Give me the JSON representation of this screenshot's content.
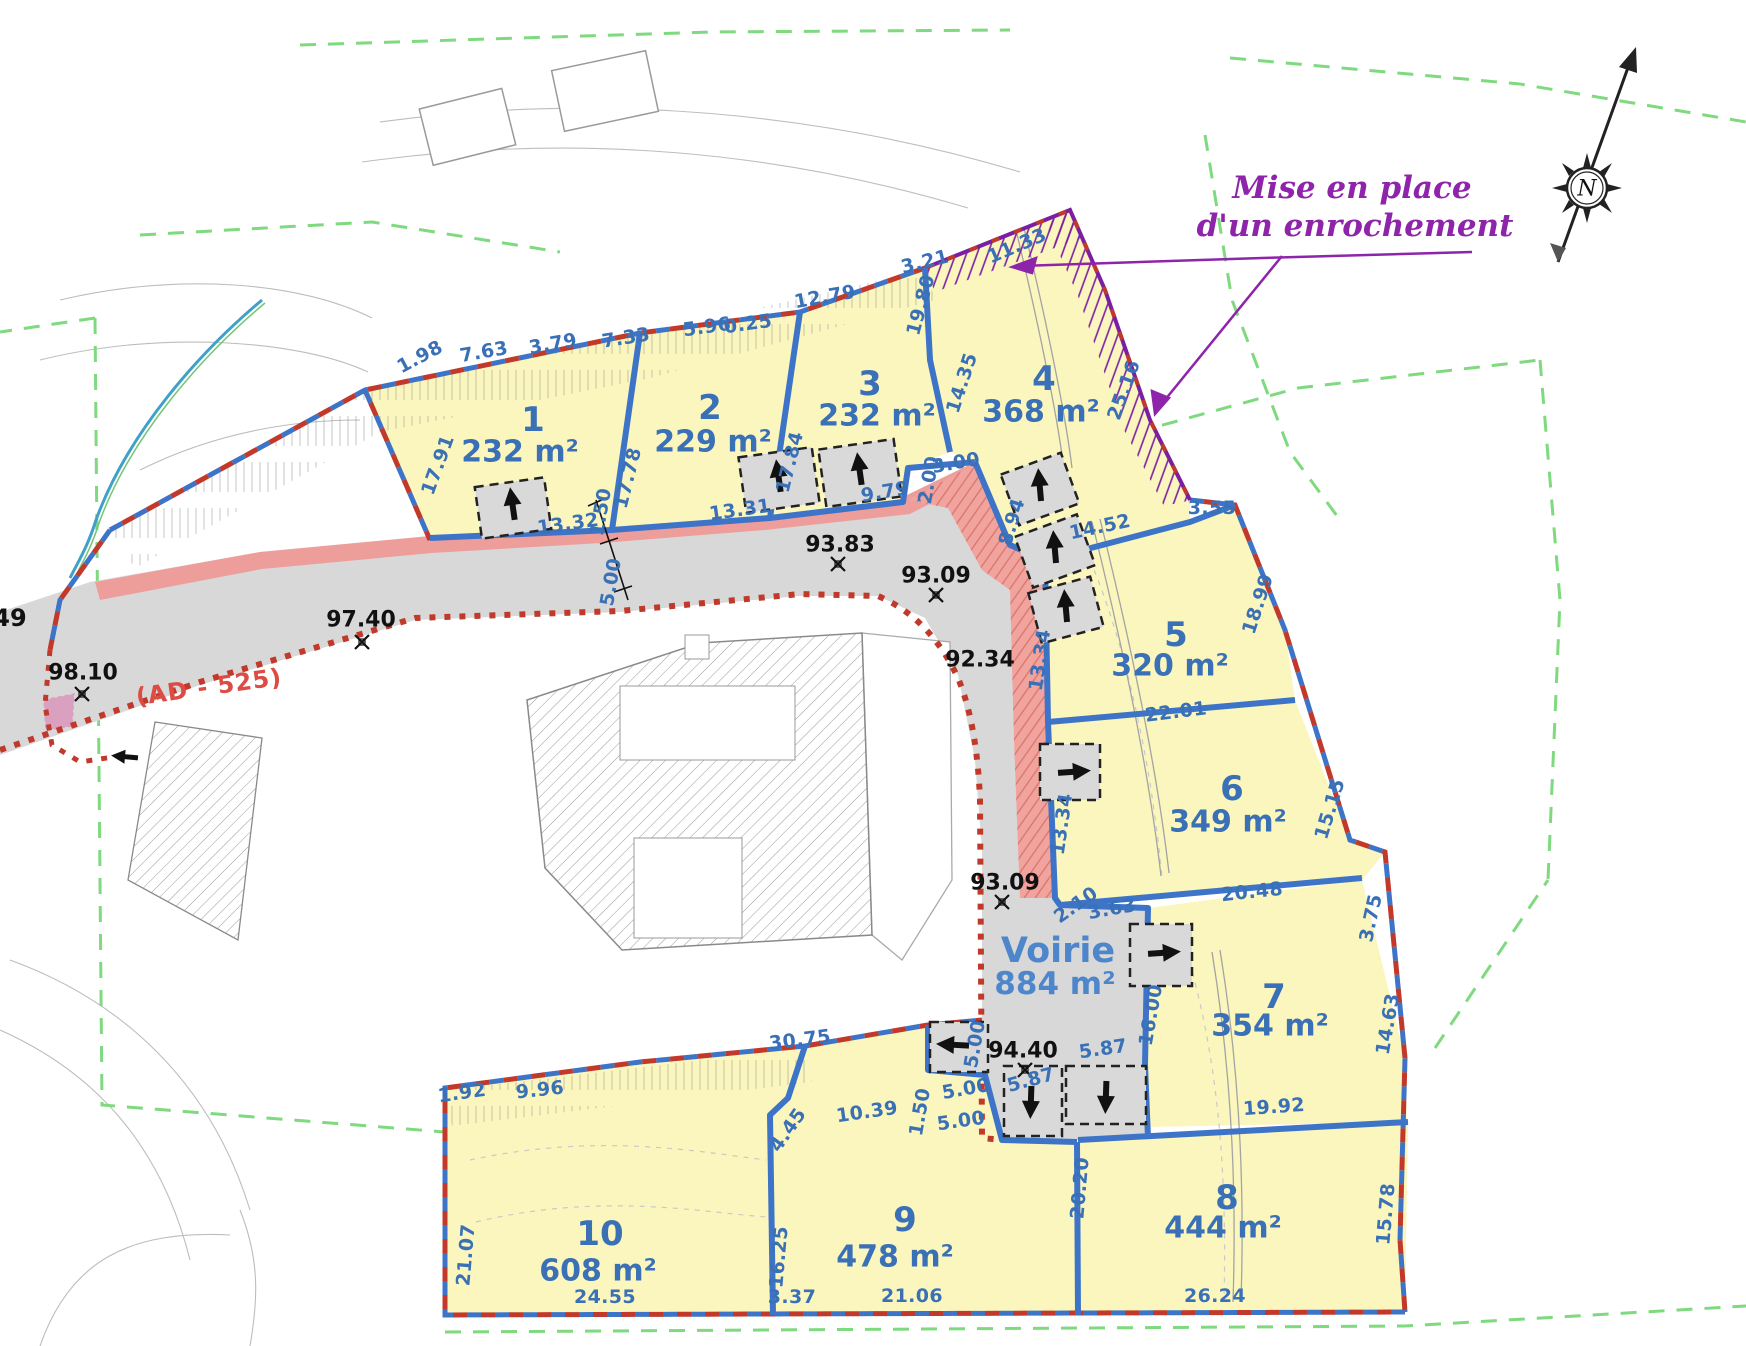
{
  "plan": {
    "annotation": {
      "line1": "Mise en place",
      "line2": "d'un enrochement"
    },
    "compass_label": "N",
    "road_label": "(AD - 525)",
    "edge_label": "49",
    "voirie": {
      "name": "Voirie",
      "area": "884 m²"
    },
    "lots": [
      {
        "num": "1",
        "area": "232 m²"
      },
      {
        "num": "2",
        "area": "229 m²"
      },
      {
        "num": "3",
        "area": "232 m²"
      },
      {
        "num": "4",
        "area": "368 m²"
      },
      {
        "num": "5",
        "area": "320 m²"
      },
      {
        "num": "6",
        "area": "349 m²"
      },
      {
        "num": "7",
        "area": "354 m²"
      },
      {
        "num": "8",
        "area": "444 m²"
      },
      {
        "num": "9",
        "area": "478 m²"
      },
      {
        "num": "10",
        "area": "608 m²"
      }
    ],
    "elevations": [
      {
        "v": "98.10"
      },
      {
        "v": "97.40"
      },
      {
        "v": "93.83"
      },
      {
        "v": "93.09"
      },
      {
        "v": "92.34"
      },
      {
        "v": "93.09"
      },
      {
        "v": "94.40"
      }
    ],
    "dims": [
      {
        "v": "1.98"
      },
      {
        "v": "7.63"
      },
      {
        "v": "3.79"
      },
      {
        "v": "7.33"
      },
      {
        "v": "5.96"
      },
      {
        "v": "0.25"
      },
      {
        "v": "12.79"
      },
      {
        "v": "3.21"
      },
      {
        "v": "11.33"
      },
      {
        "v": "17.91"
      },
      {
        "v": "17.78"
      },
      {
        "v": "17.84"
      },
      {
        "v": "19.80"
      },
      {
        "v": "14.35"
      },
      {
        "v": "25.16"
      },
      {
        "v": "13.32"
      },
      {
        "v": "13.31"
      },
      {
        "v": "9.79"
      },
      {
        "v": "2.00"
      },
      {
        "v": "3.00"
      },
      {
        "v": "8.94"
      },
      {
        "v": "14.52"
      },
      {
        "v": "3.55"
      },
      {
        "v": "1.50"
      },
      {
        "v": "5.00"
      },
      {
        "v": "18.99"
      },
      {
        "v": "22.01"
      },
      {
        "v": "13.34"
      },
      {
        "v": "13.34"
      },
      {
        "v": "15.15"
      },
      {
        "v": "20.48"
      },
      {
        "v": "2.10"
      },
      {
        "v": "3.63"
      },
      {
        "v": "16.00"
      },
      {
        "v": "3.75"
      },
      {
        "v": "14.63"
      },
      {
        "v": "5.00"
      },
      {
        "v": "5.87"
      },
      {
        "v": "5.87"
      },
      {
        "v": "5.00"
      },
      {
        "v": "19.92"
      },
      {
        "v": "20.20"
      },
      {
        "v": "15.78"
      },
      {
        "v": "1.92"
      },
      {
        "v": "9.96"
      },
      {
        "v": "30.75"
      },
      {
        "v": "4.45"
      },
      {
        "v": "10.39"
      },
      {
        "v": "1.50"
      },
      {
        "v": "5.00"
      },
      {
        "v": "21.07"
      },
      {
        "v": "16.25"
      },
      {
        "v": "24.55"
      },
      {
        "v": "3.37"
      },
      {
        "v": "21.06"
      },
      {
        "v": "26.24"
      }
    ],
    "colors": {
      "lot_fill": "#FBF6BE",
      "line_blue": "#3D74C8",
      "dim_blue": "#3A70B6",
      "boundary_red": "#C0392B",
      "purple": "#8E24AA",
      "green": "#7FD97F",
      "road_gray": "#D8D8D8",
      "pink_band": "#EE9E9A"
    }
  }
}
